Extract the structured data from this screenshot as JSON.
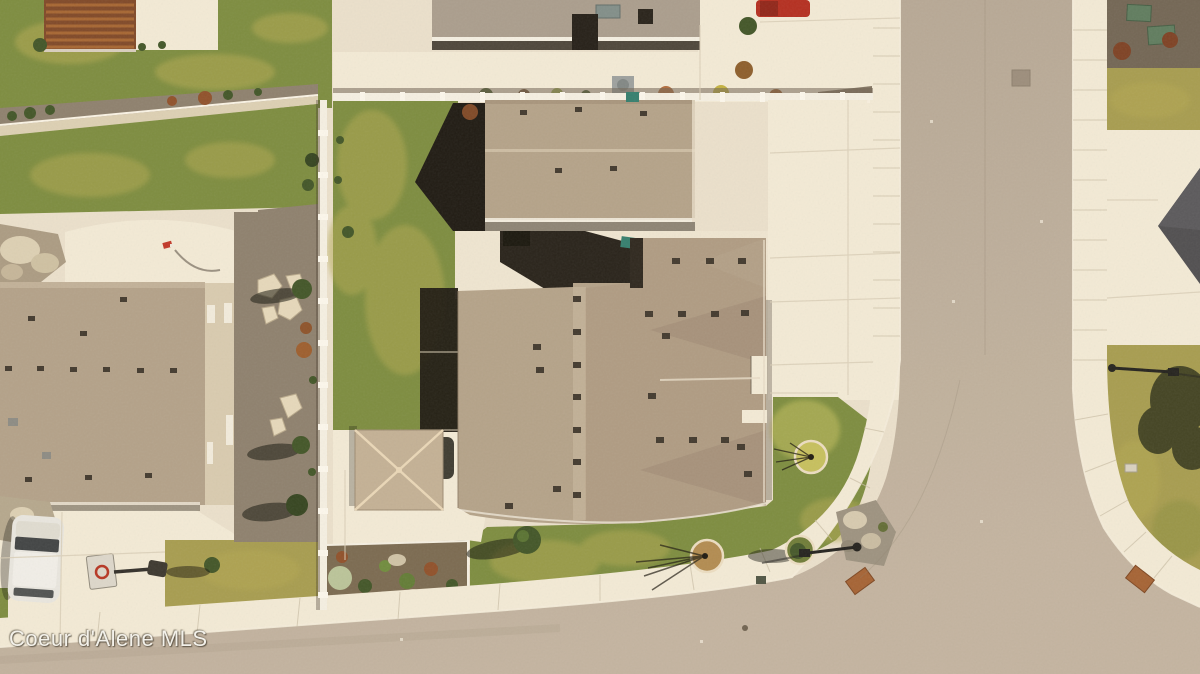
{
  "watermark": {
    "text": "Coeur d'Alene MLS"
  },
  "scene": {
    "type": "aerial-drone-photograph",
    "description": "Top-down aerial view of a suburban residential corner lot: large tan-shingled house with driveway, green front and back lawns, detached gazebo, neighboring homes, white vinyl fences, and an L-shaped street with sidewalks meeting at a curved corner.",
    "elements": [
      "main-house-roof",
      "second-house-roof",
      "rear-neighbor-house",
      "left-house-roof",
      "neighbor-roof-corner",
      "gazebo-roof",
      "vertical-street",
      "bottom-street",
      "sidewalk",
      "curb-corner-mats",
      "front-lawn",
      "back-lawn",
      "tree-rings",
      "street-lamp",
      "white-suv",
      "red-truck",
      "basketball-hoop",
      "utility-boxes",
      "landscape-beds",
      "white-fence",
      "pergola",
      "rock-beds",
      "flagstone-path"
    ]
  },
  "palette": {
    "concrete": "#ebe2cf",
    "concrete_bright": "#f4ecda",
    "road": "#b4a695",
    "road_light": "#c3b5a3",
    "curb": "#f6efdf",
    "lawn_green": "#798b3d",
    "lawn_yellow": "#b1a84f",
    "lawn_dry": "#a59b4d",
    "roof_tan": "#b3a28a",
    "roof_tan_dark": "#a8947d",
    "roof_ridge": "#d2c4ab",
    "roof_gray": "#a89c8e",
    "roof_charcoal": "#4a4a4e",
    "shadow_dark": "#17140e",
    "gravel": "#8b7e6d",
    "mulch": "#77674f",
    "fence_white": "#f6f2e6",
    "stone_light": "#ddd1b6",
    "foliage_dark": "#3c5224",
    "foliage_rust": "#8d4c26",
    "utility_green": "#5a7a5d",
    "truck_red": "#b3291c",
    "suv_white": "#e9e8e3",
    "toy_red": "#c03224",
    "teal_bin": "#2e7c6d",
    "lamp_black": "#1c1c1a",
    "ada_mat": "#a35f31"
  }
}
